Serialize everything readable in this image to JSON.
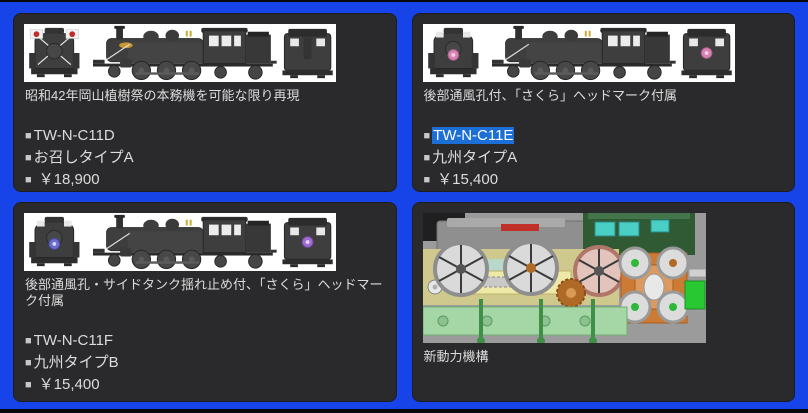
{
  "theme": {
    "frame_blue": "#1744e8",
    "panel_bg": "#2a2a2c",
    "text": "#dcdcdc",
    "selection_bg": "#1b6fd6",
    "selection_text": "#ffffff",
    "image_bg": "#ffffff"
  },
  "labels": {
    "bullet": "■"
  },
  "products": [
    {
      "caption": "昭和42年岡山植樹祭の本務機を可能な限り再現",
      "code": "TW-N-C11D",
      "variant": "お召しタイプA",
      "price": "￥18,900",
      "image": "locomotive-C11-imperial-train-three-views"
    },
    {
      "caption": "後部通風孔付、「さくら」ヘッドマーク付属",
      "code": "TW-N-C11E",
      "variant": "九州タイプA",
      "price": "￥15,400",
      "code_selected": true,
      "image": "locomotive-C11-sakura-headmark-three-views"
    },
    {
      "caption": "後部通風孔・サイドタンク揺れ止め付、「さくら」ヘッドマーク付属",
      "code": "TW-N-C11F",
      "variant": "九州タイプB",
      "price": "￥15,400",
      "image": "locomotive-C11-sakura-headmark-three-views"
    },
    {
      "caption": "新動力機構",
      "image": "drive-mechanism-cad-render"
    }
  ]
}
